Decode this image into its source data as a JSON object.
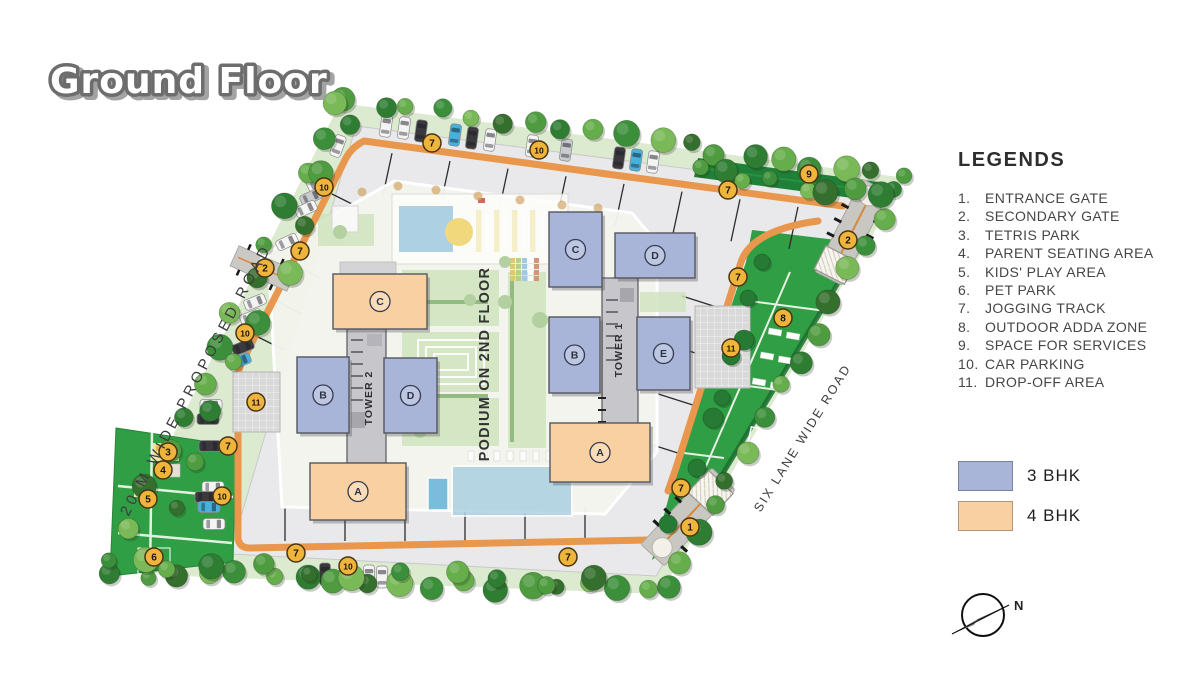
{
  "title": "Ground Floor",
  "legends": {
    "heading": "LEGENDS",
    "items": [
      {
        "num": "1.",
        "label": "ENTRANCE GATE"
      },
      {
        "num": "2.",
        "label": "SECONDARY GATE"
      },
      {
        "num": "3.",
        "label": "TETRIS PARK"
      },
      {
        "num": "4.",
        "label": "PARENT SEATING AREA"
      },
      {
        "num": "5.",
        "label": "KIDS' PLAY AREA"
      },
      {
        "num": "6.",
        "label": "PET PARK"
      },
      {
        "num": "7.",
        "label": "JOGGING TRACK"
      },
      {
        "num": "8.",
        "label": "OUTDOOR ADDA ZONE"
      },
      {
        "num": "9.",
        "label": "SPACE FOR SERVICES"
      },
      {
        "num": "10.",
        "label": "CAR PARKING"
      },
      {
        "num": "11.",
        "label": "DROP-OFF AREA"
      }
    ]
  },
  "unit_legend": [
    {
      "label": "3 BHK",
      "type": "3bhk"
    },
    {
      "label": "4 BHK",
      "type": "4bhk"
    }
  ],
  "colors": {
    "bhk3": "#a9b4d9",
    "bhk4": "#f8d0a2",
    "track": "#e9974d",
    "marker": "#eeb43c",
    "lawn": "#2f9e44"
  },
  "compass": {
    "n": "N"
  },
  "plan": {
    "road_left": {
      "label": "20 M WIDE PROPOSED ROAD"
    },
    "road_right": {
      "label": "SIX LANE WIDE ROAD"
    },
    "podium_label": "PODIUM ON 2ND FLOOR",
    "tower1_label": "TOWER 1",
    "tower2_label": "TOWER 2",
    "buildings": [
      {
        "letter": "C",
        "type": "4bhk",
        "x": 333,
        "y": 274,
        "w": 94,
        "h": 55
      },
      {
        "letter": "B",
        "type": "3bhk",
        "x": 297,
        "y": 357,
        "w": 52,
        "h": 76
      },
      {
        "letter": "D",
        "type": "3bhk",
        "x": 384,
        "y": 358,
        "w": 53,
        "h": 75
      },
      {
        "letter": "A",
        "type": "4bhk",
        "x": 310,
        "y": 463,
        "w": 96,
        "h": 57
      },
      {
        "letter": "C",
        "type": "3bhk",
        "x": 549,
        "y": 212,
        "w": 53,
        "h": 75
      },
      {
        "letter": "D",
        "type": "3bhk",
        "x": 615,
        "y": 233,
        "w": 80,
        "h": 45
      },
      {
        "letter": "B",
        "type": "3bhk",
        "x": 549,
        "y": 317,
        "w": 51,
        "h": 76
      },
      {
        "letter": "E",
        "type": "3bhk",
        "x": 637,
        "y": 317,
        "w": 53,
        "h": 73
      },
      {
        "letter": "A",
        "type": "4bhk",
        "x": 550,
        "y": 423,
        "w": 100,
        "h": 59
      }
    ],
    "markers": [
      {
        "n": "7",
        "x": 432,
        "y": 143
      },
      {
        "n": "10",
        "x": 539,
        "y": 150
      },
      {
        "n": "9",
        "x": 809,
        "y": 174
      },
      {
        "n": "7",
        "x": 728,
        "y": 190
      },
      {
        "n": "2",
        "x": 848,
        "y": 240
      },
      {
        "n": "10",
        "x": 324,
        "y": 187
      },
      {
        "n": "7",
        "x": 300,
        "y": 251
      },
      {
        "n": "2",
        "x": 265,
        "y": 268
      },
      {
        "n": "10",
        "x": 245,
        "y": 333
      },
      {
        "n": "11",
        "x": 256,
        "y": 402
      },
      {
        "n": "7",
        "x": 738,
        "y": 277
      },
      {
        "n": "8",
        "x": 783,
        "y": 318
      },
      {
        "n": "11",
        "x": 731,
        "y": 348
      },
      {
        "n": "7",
        "x": 228,
        "y": 446
      },
      {
        "n": "3",
        "x": 168,
        "y": 452
      },
      {
        "n": "4",
        "x": 163,
        "y": 470
      },
      {
        "n": "5",
        "x": 148,
        "y": 499
      },
      {
        "n": "10",
        "x": 222,
        "y": 496
      },
      {
        "n": "6",
        "x": 154,
        "y": 557
      },
      {
        "n": "7",
        "x": 681,
        "y": 488
      },
      {
        "n": "1",
        "x": 690,
        "y": 527
      },
      {
        "n": "7",
        "x": 568,
        "y": 557
      },
      {
        "n": "7",
        "x": 296,
        "y": 553
      },
      {
        "n": "10",
        "x": 348,
        "y": 566
      }
    ]
  }
}
